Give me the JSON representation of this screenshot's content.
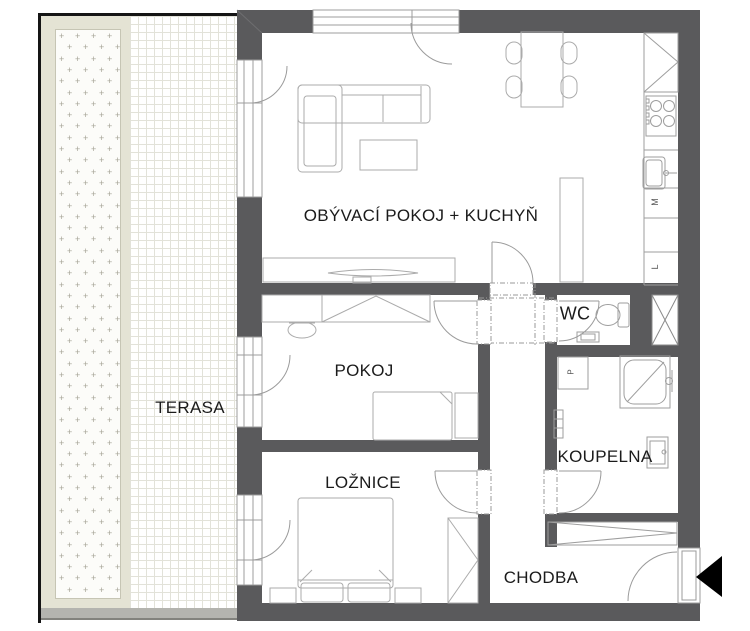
{
  "floorplan": {
    "rooms": {
      "living": "OBÝVACÍ POKOJ + KUCHYŇ",
      "room": "POKOJ",
      "bedroom": "LOŽNICE",
      "wc": "WC",
      "bathroom": "KOUPELNA",
      "hallway": "CHODBA",
      "terrace": "TERASA"
    },
    "appliances": {
      "dishwasher": "M",
      "fridge": "L",
      "washer": "P"
    },
    "colors": {
      "wall": "#5a5a5c",
      "furniture_line": "#ababab",
      "terrace_band": "#e4e3d4",
      "entrance_arrow": "#000000"
    }
  }
}
